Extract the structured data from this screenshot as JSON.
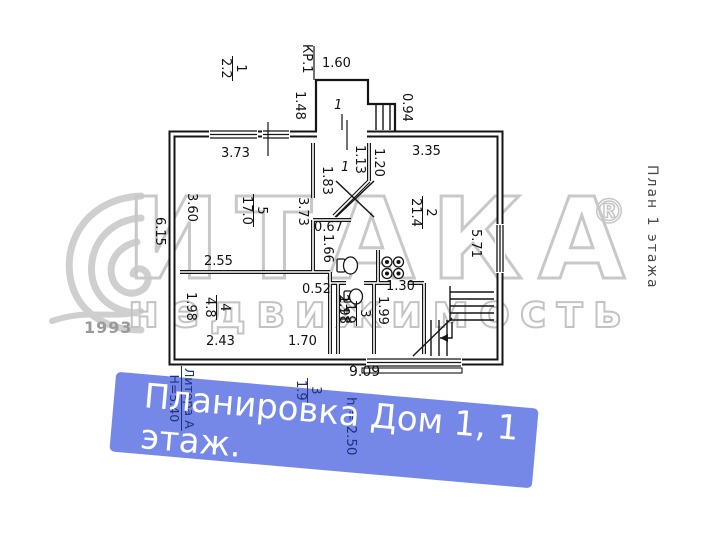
{
  "side_label": "План 1 этажа",
  "watermark": {
    "brand": "ИТАКА",
    "reg": "®",
    "tagline": "недвижимость",
    "year": "1993"
  },
  "banner": {
    "line1": "Планировка Дом 1, 1",
    "line2": "этаж.",
    "bg": "#7688e7"
  },
  "overlay": {
    "litera": "Литера А",
    "building_height": "Н=5.40",
    "floor_height": "h = 2.50",
    "wc": {
      "num": "3",
      "area": "1.9"
    }
  },
  "plan": {
    "kr_label": "КР.1",
    "total_width": "9.09",
    "porch": {
      "num": "1",
      "width": "1.60",
      "height": "1.48",
      "stairs": "0.94",
      "area_num": "1",
      "area_val": "2.2"
    },
    "hall": {
      "num": "1",
      "d1": "1.13",
      "d2": "1.20",
      "d3": "1.83"
    },
    "room5": {
      "num": "5",
      "area": "17.0",
      "top": "3.73",
      "left_in": "3.60",
      "left_out": "6.15",
      "right": "3.73"
    },
    "room2": {
      "num": "2",
      "area": "21.4",
      "top": "3.35",
      "right": "5.71"
    },
    "kitchen": {
      "d1": "0.67",
      "d2": "1.66"
    },
    "room4": {
      "num": "4",
      "area": "4.8",
      "top": "2.55",
      "left": "1.98",
      "bottom": "2.43",
      "right": "2.11"
    },
    "room3": {
      "num": "3",
      "area": "1.9",
      "height": "1.98",
      "pass": "0.52"
    },
    "lobby": {
      "width": "1.30",
      "height": "1.99",
      "bottom": "1.70"
    }
  }
}
